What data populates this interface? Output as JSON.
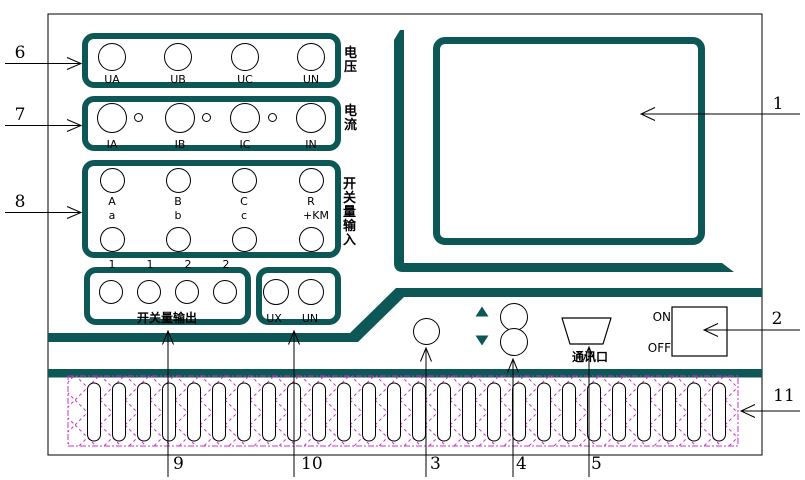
{
  "colors": {
    "panel_teal": "#0d5757",
    "hatch_magenta": "#cc33cc"
  },
  "voltage_group": {
    "side_label": "电压",
    "terminals": [
      "UA",
      "UB",
      "UC",
      "UN"
    ]
  },
  "current_group": {
    "side_label": "电流",
    "terminals": [
      "IA",
      "IB",
      "IC",
      "IN"
    ]
  },
  "switch_input_group": {
    "side_label": "开关量输入",
    "row1": [
      "A",
      "B",
      "C",
      "R"
    ],
    "row2": [
      "a",
      "b",
      "c",
      "+KM"
    ]
  },
  "switch_output_group": {
    "label": "开关量输出",
    "pins": [
      "1",
      "1",
      "2",
      "2"
    ]
  },
  "aux_voltage_group": {
    "terminals": [
      "UX",
      "UN"
    ]
  },
  "power_switch": {
    "on": "ON",
    "off": "OFF"
  },
  "comm_port_label": "通讯口",
  "callouts": {
    "n1": "1",
    "n2": "2",
    "n3": "3",
    "n4": "4",
    "n5": "5",
    "n6": "6",
    "n7": "7",
    "n8": "8",
    "n9": "9",
    "n10": "10",
    "n11": "11"
  },
  "vent": {
    "slot_count": 26
  }
}
